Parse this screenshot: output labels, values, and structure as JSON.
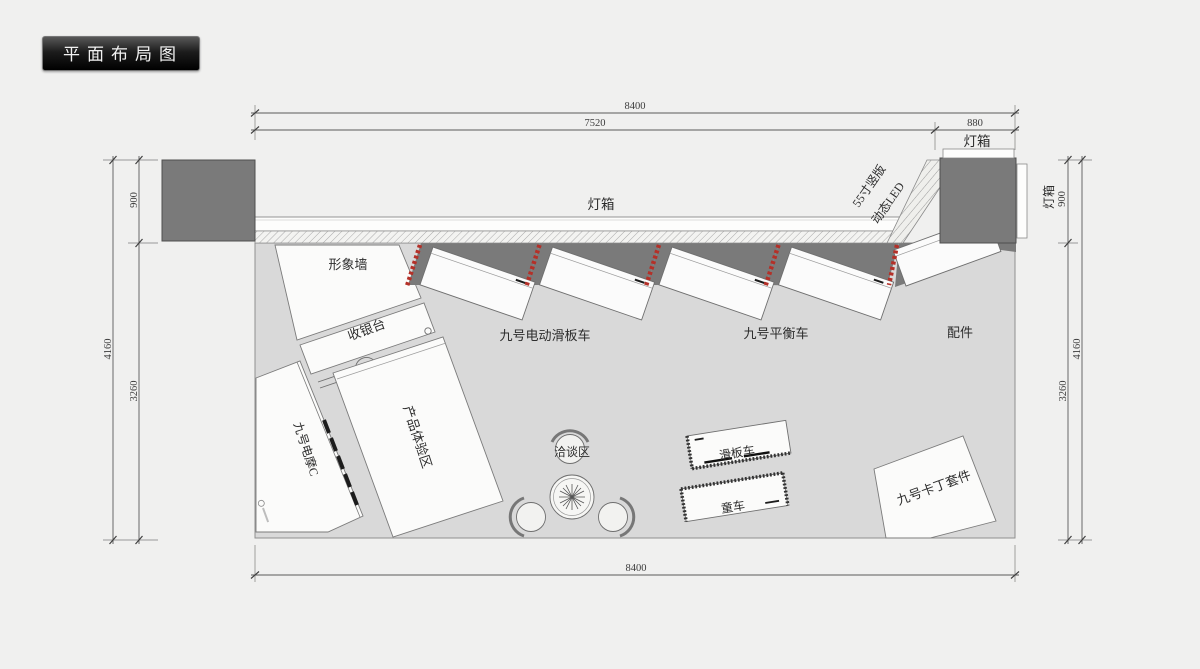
{
  "title_badge": {
    "text": "平面布局图"
  },
  "dimensions": {
    "top": {
      "total": "8400",
      "main": "7520",
      "corner": "880"
    },
    "bottom": {
      "total": "8400"
    },
    "left": {
      "total": "4160",
      "upper": "900",
      "lower": "3260"
    },
    "right": {
      "total": "4160",
      "upper": "900",
      "lower": "3260",
      "lightbox": "灯箱"
    }
  },
  "walls": {
    "lightbox_label": "灯箱",
    "corner_lightbox_label": "灯箱",
    "led_sign": {
      "line1": "55寸竖版",
      "line2": "动态LED"
    }
  },
  "zones": {
    "image_wall": "形象墙",
    "cashier": "收银台",
    "experience_zone": "产品体验区",
    "emoped_c": "九号电摩C",
    "negotiation_area": "洽谈区",
    "kart_kit": "九号卡丁套件"
  },
  "displays": {
    "escooter": "九号电动滑板车",
    "balance_car": "九号平衡车",
    "accessories": "配件",
    "scooter_table": "滑板车",
    "kids_car": "童车"
  },
  "colors": {
    "accent_red": "#b43028",
    "dark_fill": "#7a7a7a",
    "floor": "#d9d9d9",
    "background": "#f0f0ef"
  }
}
